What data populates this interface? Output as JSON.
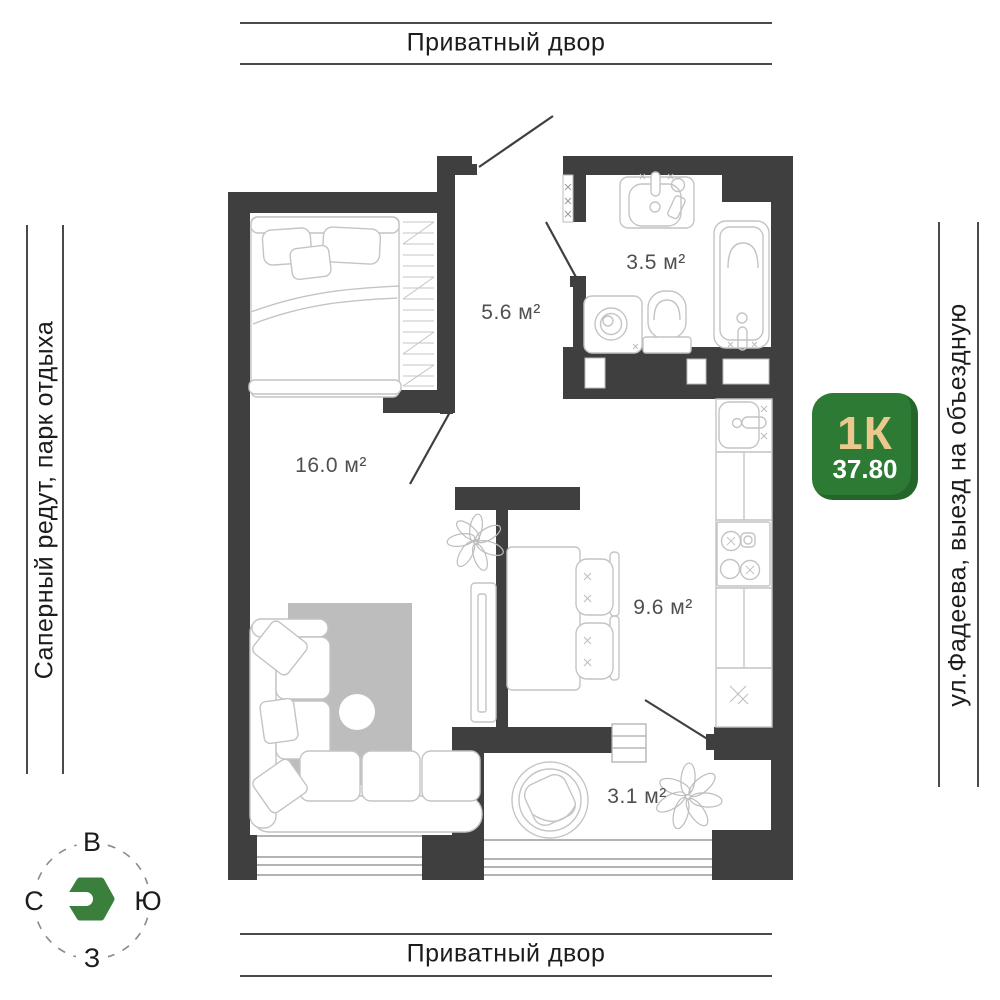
{
  "surroundings": {
    "top_label": "Приватный двор",
    "bottom_label": "Приватный двор",
    "left_label": "Саперный редут, парк отдыха",
    "right_label": "ул.Фадеева, выезд на объездную"
  },
  "badge": {
    "type_label": "1К",
    "area_value": "37.80",
    "bg_color": "#2C7A33",
    "type_color": "#EAC88E",
    "area_color": "#FFFFFF"
  },
  "compass": {
    "north": "С",
    "east": "В",
    "south": "Ю",
    "west": "З",
    "logo_color": "#3B7F3C"
  },
  "plan": {
    "rooms": [
      {
        "id": "living-room",
        "area_label": "16.0 м²"
      },
      {
        "id": "hallway",
        "area_label": "5.6 м²"
      },
      {
        "id": "bathroom",
        "area_label": "3.5 м²"
      },
      {
        "id": "kitchen",
        "area_label": "9.6 м²"
      },
      {
        "id": "balcony",
        "area_label": "3.1 м²"
      }
    ],
    "wall_color": "#3F3F3F",
    "furniture_color": "#C4C4C4",
    "rug_color": "#BDBDBD"
  }
}
